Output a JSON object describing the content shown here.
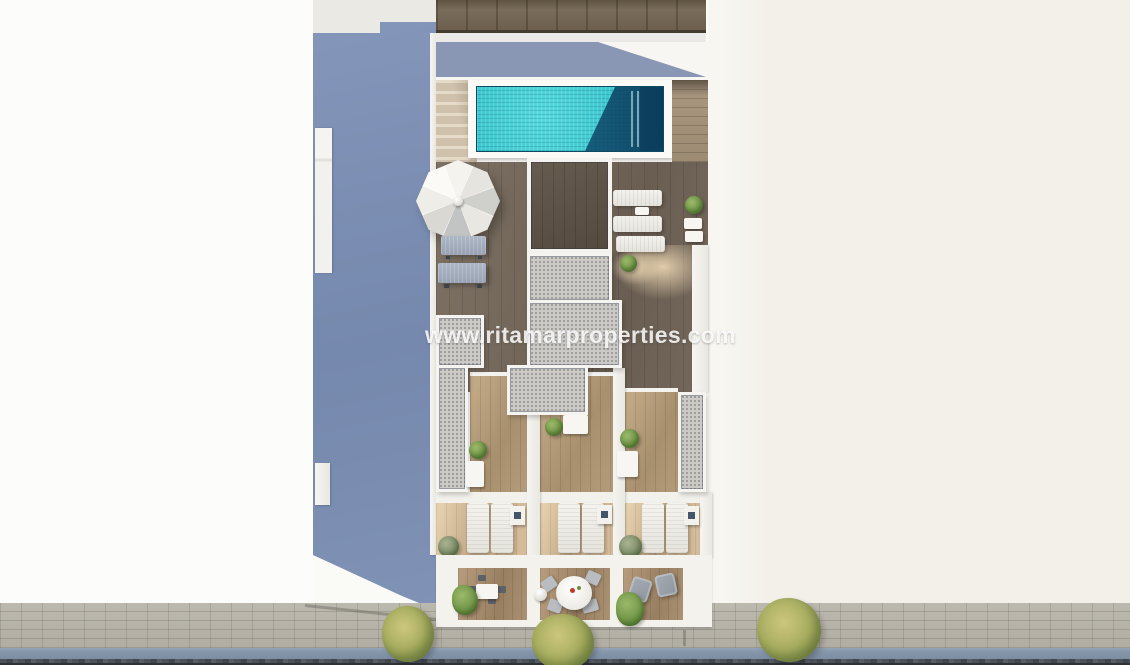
{
  "watermark": {
    "text": "www.ritamarproperties.com"
  },
  "scene": {
    "type": "aerial 3D architectural render",
    "subject": "penthouse roof terrace with swimming pool, private terraces and street-level balconies",
    "objects": [
      "neighboring-roof",
      "shaded-side-wall",
      "swimming-pool",
      "pool-stairs",
      "parasol",
      "sun-loungers",
      "roof-deck",
      "stairwell-roofs",
      "private-terraces",
      "lounger-terraces",
      "balconies",
      "sidewalk",
      "street-trees",
      "road"
    ]
  },
  "palette": {
    "background_left": "#fcfcfb",
    "background_right": "#f3f0ea",
    "shadow_wall_blue": "#7d90b4",
    "pool_water": "#3cc9cf",
    "pool_water_shadow": "#1d6d91",
    "deck_wood_dark": "#71655a",
    "terrace_wood": "#b09878",
    "concrete_roof": "#cbcac6",
    "sidewalk": "#bcb9af",
    "curb": "#8495aa",
    "road": "#4a5058",
    "foliage_green": "#6f9445",
    "foliage_yellow": "#a3aa5c",
    "furniture_white": "#f2f1ec"
  }
}
